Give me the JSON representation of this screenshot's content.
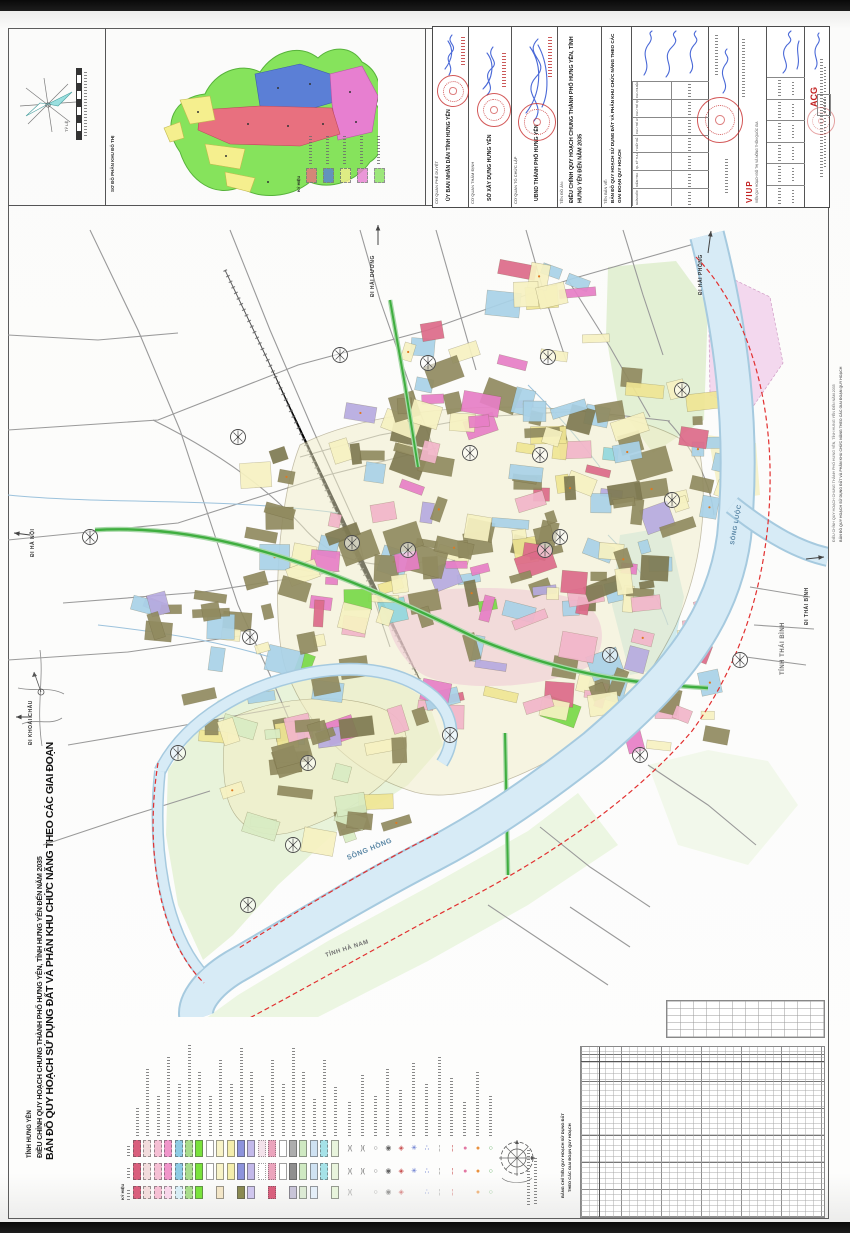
{
  "side_titles": {
    "province": "TỈNH HƯNG YÊN",
    "project": "ĐIỀU CHỈNH QUY HOẠCH CHUNG THÀNH PHỐ HƯNG YÊN, TỈNH HƯNG YÊN ĐẾN NĂM 2035",
    "drawing": "BẢN ĐỒ QUY HOẠCH SỬ DỤNG ĐẤT VÀ PHÂN KHU CHỨC NĂNG THEO CÁC GIAI ĐOẠN QUY HOẠCH"
  },
  "scale": {
    "label": "TỶ LỆ"
  },
  "inset": {
    "title": "SƠ ĐỒ PHÂN KHU ĐÔ THỊ",
    "legend_header": "KÝ HIỆU",
    "zones": [
      {
        "label": "1",
        "color": "#e8707f"
      },
      {
        "label": "2",
        "color": "#5b7fd6"
      },
      {
        "label": "3",
        "color": "#f5ef8e"
      },
      {
        "label": "4",
        "color": "#e77fd0"
      },
      {
        "label": "5",
        "color": "#86e35c"
      }
    ]
  },
  "title_block": {
    "orgs": [
      {
        "label": "CƠ QUAN PHÊ DUYỆT",
        "name": "ỦY BAN NHÂN DÂN TỈNH HƯNG YÊN"
      },
      {
        "label": "CƠ QUAN THẨM ĐỊNH",
        "name": "SỞ XÂY DỰNG HƯNG YÊN"
      },
      {
        "label": "CƠ QUAN TỔ CHỨC LẬP",
        "name": "UBND THÀNH PHỐ HƯNG YÊN"
      }
    ],
    "project_label": "TÊN ĐỒ ÁN:",
    "project_name": "ĐIỀU CHỈNH QUY HOẠCH CHUNG THÀNH PHỐ HƯNG YÊN, TỈNH HƯNG YÊN ĐẾN NĂM 2035",
    "drawing_label": "TÊN BẢN VẼ:",
    "drawing_name": "BẢN ĐỒ QUY HOẠCH SỬ DỤNG ĐẤT VÀ PHÂN KHU CHỨC NĂNG THEO CÁC GIAI ĐOẠN QUY HOẠCH",
    "roles": [
      "CHỦ NHIỆM",
      "CHỦ TRÌ QH",
      "CHỦ TRÌ HT",
      "THIẾT KẾ",
      "QL KỸ THUẬT",
      "KIỂM TRA",
      "GIÁM ĐỐC"
    ],
    "viup_logo": "VIUP",
    "viup_name": "VIỆN QUY HOẠCH ĐÔ THỊ VÀ NÔNG THÔN QUỐC GIA",
    "acg_logo": "ACG"
  },
  "legend": {
    "header": "KÝ HIỆU",
    "columns": [
      {
        "rows": [
          "#d95f7d",
          "#d95f7d",
          "#d95f7d"
        ],
        "style": "dashed"
      },
      {
        "rows": [
          "#f2dcdc",
          "#f2dcdc",
          "#f2dcdc"
        ],
        "style": "dashed"
      },
      {
        "rows": [
          "#f5c0d4",
          "#f5c0d4",
          "#f5c0d4"
        ],
        "style": "dashed"
      },
      {
        "rows": [
          "#f096ca",
          "#f096ca",
          "#f8d6ea"
        ],
        "style": "dashed"
      },
      {
        "rows": [
          "#8ecbe4",
          "#8ecbe4",
          "#d8edf6"
        ],
        "style": "dashed"
      },
      {
        "rows": [
          "#a8dc8c",
          "#a8dc8c",
          "#a8dc8c"
        ],
        "style": "dashed"
      },
      {
        "rows": [
          "#79e23c",
          "#79e23c",
          "#79e23c"
        ],
        "style": "solid"
      },
      {
        "rows": [
          "#ffffff",
          "#ffffff",
          null
        ],
        "style": "solid"
      },
      {
        "rows": [
          "#f8f3c8",
          "#f8f3c8",
          "#f3e6c8"
        ],
        "style": "solid"
      },
      {
        "rows": [
          "#f4eeac",
          "#f4eeac",
          null
        ],
        "style": "solid"
      },
      {
        "rows": [
          "#8d93dc",
          "#8d93dc",
          "#8a8a52"
        ],
        "style": "solid"
      },
      {
        "rows": [
          "#c3b9ea",
          "#c3b9ea",
          "#cfc6ee"
        ],
        "style": "solid"
      },
      {
        "rows": [
          "#f3e2ea",
          "#ffffff",
          null
        ],
        "style": "dotted"
      },
      {
        "rows": [
          "#eba4bc",
          "#eba4bc",
          "#d95f7d"
        ],
        "style": "dotted"
      },
      {
        "rows": [
          "#ffffff",
          "#ffffff",
          null
        ],
        "style": "solid"
      },
      {
        "rows": [
          "#adadad",
          "#8f8f8f",
          "#c8c4d8"
        ],
        "style": "solid"
      },
      {
        "rows": [
          "#cfe9c2",
          "#cfe9c2",
          "#dcead4"
        ],
        "style": "solid"
      },
      {
        "rows": [
          "#cfe2f2",
          "#cfe2f2",
          "#e4eef8"
        ],
        "style": "solid"
      },
      {
        "rows": [
          "#a5e2e8",
          "#a5e2e8",
          null
        ],
        "style": "dashed"
      },
      {
        "rows": [
          "#e8f4dc",
          "#e8f4dc",
          "#e8f4dc"
        ],
        "style": "solid"
      }
    ],
    "symbols": [
      "parallel-bridge",
      "parallel-bridge",
      "small-circle",
      "interchange-spiral",
      "station-diamond",
      "blue-junction",
      "blue-nodes",
      "gray-dash-line",
      "red-dash-line",
      "pink-node",
      "orange-node",
      "green-ring"
    ],
    "emblem": "boundary-marker-emblem"
  },
  "tables": {
    "title1": "BẢNG CHỈ TIÊU QUY HOẠCH SỬ DỤNG ĐẤT",
    "title2": "THEO CÁC GIAI ĐOẠN QUY HOẠCH"
  },
  "map": {
    "labels": [
      {
        "text": "SÔNG HỒNG",
        "x": 340,
        "y": 655,
        "rot": -22,
        "color": "#5b87a6",
        "fs": 7
      },
      {
        "text": "SÔNG LUỘC",
        "x": 726,
        "y": 340,
        "rot": -80,
        "color": "#5b87a6",
        "fs": 6
      },
      {
        "text": "TỈNH HÀ NAM",
        "x": 318,
        "y": 752,
        "rot": -18,
        "color": "#707070",
        "fs": 6
      },
      {
        "text": "TỈNH THÁI BÌNH",
        "x": 776,
        "y": 470,
        "rot": -90,
        "color": "#707070",
        "fs": 6
      },
      {
        "text": "ĐI HÀ NỘI",
        "x": 26,
        "y": 352,
        "rot": -90,
        "color": "#333333",
        "fs": 5
      },
      {
        "text": "ĐI KHOÁI CHÂU",
        "x": 24,
        "y": 540,
        "rot": -90,
        "color": "#333333",
        "fs": 5
      },
      {
        "text": "ĐI HẢI DƯƠNG",
        "x": 366,
        "y": 92,
        "rot": -90,
        "color": "#333333",
        "fs": 5
      },
      {
        "text": "ĐI HẢI PHÒNG",
        "x": 694,
        "y": 90,
        "rot": -90,
        "color": "#333333",
        "fs": 5
      },
      {
        "text": "ĐI THÁI BÌNH",
        "x": 800,
        "y": 420,
        "rot": -90,
        "color": "#333333",
        "fs": 5
      }
    ],
    "arrows": [
      [
        22,
        330,
        6,
        328
      ],
      [
        370,
        40,
        370,
        20
      ],
      [
        700,
        48,
        703,
        26
      ],
      [
        798,
        354,
        816,
        352
      ],
      [
        24,
        512,
        8,
        512
      ]
    ],
    "markers": [
      [
        332,
        150
      ],
      [
        420,
        158
      ],
      [
        540,
        152
      ],
      [
        230,
        232
      ],
      [
        82,
        332
      ],
      [
        344,
        338
      ],
      [
        552,
        332
      ],
      [
        664,
        295
      ],
      [
        400,
        345
      ],
      [
        537,
        345
      ],
      [
        674,
        185
      ],
      [
        462,
        248
      ],
      [
        242,
        432
      ],
      [
        170,
        548
      ],
      [
        300,
        558
      ],
      [
        442,
        530
      ],
      [
        240,
        700
      ],
      [
        602,
        450
      ],
      [
        532,
        250
      ],
      [
        632,
        550
      ],
      [
        732,
        455
      ],
      [
        285,
        640
      ]
    ],
    "palette": {
      "olive": "#918b60",
      "olive2": "#7f7a52",
      "py": "#f7f2c2",
      "yel": "#f0e694",
      "lb": "#a9d2e8",
      "pk": "#f2b6ca",
      "rd": "#dd6b8a",
      "mg": "#e77fc6",
      "gn": "#79d94a",
      "lv": "#b7abe0",
      "pg": "#d9ecc4",
      "cy": "#93d8de"
    },
    "clusters": [
      {
        "cx": 470,
        "cy": 300,
        "sx": 140,
        "sy": 105,
        "n": 52,
        "mix": "core"
      },
      {
        "cx": 340,
        "cy": 330,
        "sx": 95,
        "sy": 85,
        "n": 32,
        "mix": "core"
      },
      {
        "cx": 595,
        "cy": 330,
        "sx": 85,
        "sy": 100,
        "n": 32,
        "mix": "core"
      },
      {
        "cx": 510,
        "cy": 430,
        "sx": 125,
        "sy": 85,
        "n": 38,
        "mix": "old"
      },
      {
        "cx": 640,
        "cy": 470,
        "sx": 70,
        "sy": 75,
        "n": 20,
        "mix": "old"
      },
      {
        "cx": 275,
        "cy": 470,
        "sx": 85,
        "sy": 65,
        "n": 22,
        "mix": "core"
      },
      {
        "cx": 295,
        "cy": 575,
        "sx": 105,
        "sy": 62,
        "n": 26,
        "mix": "isle"
      },
      {
        "cx": 510,
        "cy": 180,
        "sx": 115,
        "sy": 55,
        "n": 22,
        "mix": "north"
      },
      {
        "cx": 665,
        "cy": 245,
        "sx": 55,
        "sy": 70,
        "n": 15,
        "mix": "north"
      },
      {
        "cx": 530,
        "cy": 75,
        "sx": 40,
        "sy": 25,
        "n": 9,
        "mix": "north"
      },
      {
        "cx": 180,
        "cy": 432,
        "sx": 45,
        "sy": 42,
        "n": 11,
        "mix": "west"
      }
    ]
  }
}
